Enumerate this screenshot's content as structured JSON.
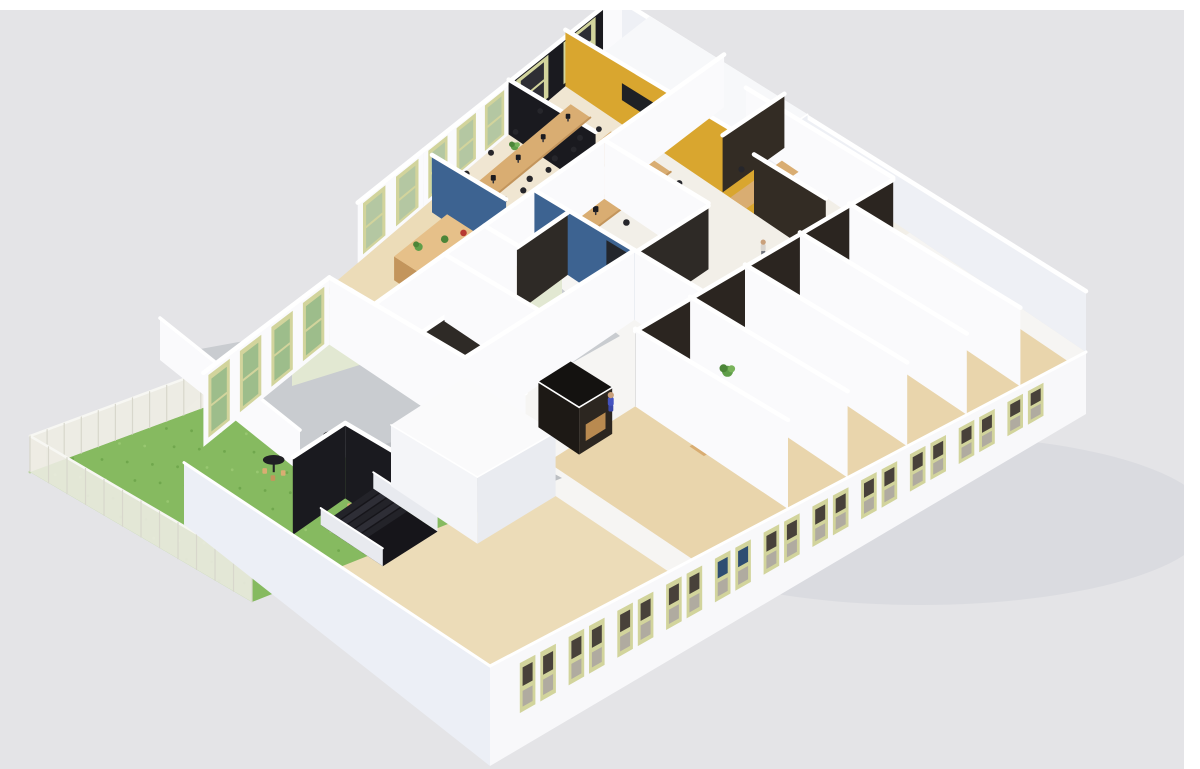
{
  "scene": {
    "description": "Isometric 3D cutaway rendering of a single-storey office floor plan with open office, meeting rooms, cafe, terrace and lawn",
    "canvas": {
      "width": 1200,
      "height": 769,
      "background": "#e4e4e7"
    },
    "frame": {
      "top_strip_height": 10,
      "right_strip_width": 16,
      "strip_color": "#ffffff"
    },
    "palette": {
      "bg": "#e4e4e7",
      "wallFace": "#fafafc",
      "wallShade": "#eef0f5",
      "wallCool": "#eceff6",
      "facade": "#f8f8fa",
      "black": "#1a1a1f",
      "glass": "#2e2a26",
      "glassDark": "#2b2520",
      "glassBrown": "#332c24",
      "accentBlue": "#3d6391",
      "accentYellow": "#d9a62f",
      "frame": "#d2d49c",
      "paneTree": "#b4c7a2",
      "paneGrass": "#9dbd8b",
      "paneNight": "#2e2e34",
      "paneDark": "#48413a",
      "paneGrey": "#b0aba0",
      "paneBlue": "#2e4d72",
      "floorWhite": "#f6f5f3",
      "floorWood1": "#ecdcb8",
      "floorWood2": "#f0e6d2",
      "floorWood3": "#e9d5ac",
      "floorCool": "#f2efe8",
      "wood": "#d9ad72",
      "woodDark": "#c3955c",
      "deskTop": "#e6c089",
      "chair": "#26262b",
      "monitor": "#1b1b20",
      "grass": "#86ba60",
      "grassDark": "#6aa348",
      "path": "#bcbfc3",
      "terrace": "#c9ccd0",
      "greenWall": "#e2e8d2",
      "green": "#5f9e49",
      "greenDark": "#4c8538",
      "skin": "#c9a07b",
      "yellowChair": "#dba63e",
      "rail": "#e8eaef"
    },
    "projection": {
      "quad": [
        [
          150,
          440
        ],
        [
          622,
          38
        ],
        [
          1086,
          352
        ],
        [
          490,
          666
        ]
      ],
      "wall_height": {
        "base": 46,
        "u_gain": 26,
        "v_gain": 30
      }
    },
    "shadow": {
      "cx": 920,
      "cy": 520,
      "rx": 290,
      "ry": 85,
      "color": "#cfd0d6",
      "opacity": 0.45
    },
    "floors": [
      {
        "id": "floor-slab",
        "poly": [
          [
            0,
            0
          ],
          [
            1,
            0
          ],
          [
            1,
            1
          ],
          [
            0,
            1
          ]
        ],
        "fill": "floorWhite",
        "z": 0
      },
      {
        "id": "floor-reception",
        "poly": [
          [
            0.3,
            0
          ],
          [
            0.58,
            0
          ],
          [
            0.58,
            0.22
          ],
          [
            0.3,
            0.22
          ]
        ],
        "fill": "floorWood1",
        "z": 0.1
      },
      {
        "id": "floor-open-office",
        "poly": [
          [
            0.58,
            0
          ],
          [
            0.88,
            0
          ],
          [
            0.88,
            0.3
          ],
          [
            0.58,
            0.3
          ]
        ],
        "fill": "floorWood2",
        "z": 0.1
      },
      {
        "id": "floor-cafe",
        "poly": [
          [
            0,
            0.1
          ],
          [
            0.3,
            0.1
          ],
          [
            0.3,
            1
          ],
          [
            0,
            1
          ]
        ],
        "fill": "floorWood1",
        "z": 0.1
      },
      {
        "id": "floor-right-cluster",
        "poly": [
          [
            0.62,
            0.22
          ],
          [
            1,
            0.22
          ],
          [
            1,
            0.62
          ],
          [
            0.62,
            0.62
          ]
        ],
        "fill": "floorCool",
        "z": 0.1
      },
      {
        "id": "floor-front-offices",
        "poly": [
          [
            0.34,
            0.62
          ],
          [
            0.97,
            0.62
          ],
          [
            0.97,
            1
          ],
          [
            0.34,
            1
          ]
        ],
        "fill": "floorWood3",
        "z": 0.1
      }
    ],
    "floor_patch": {
      "id": "floor-patch-reception",
      "poly": [
        [
          0.4,
          0
        ],
        [
          0.62,
          0
        ],
        [
          0.62,
          0.3
        ],
        [
          0.4,
          0.3
        ]
      ],
      "fill": "floorWood1",
      "z": 9
    },
    "outdoor": {
      "lawn": {
        "points": [
          [
            30,
            472
          ],
          [
            235,
            396
          ],
          [
            458,
            520
          ],
          [
            252,
            602
          ]
        ],
        "fill": "grass",
        "z": 1
      },
      "path": {
        "points": [
          [
            235,
            396
          ],
          [
            340,
            357
          ],
          [
            562,
            478
          ],
          [
            458,
            520
          ]
        ],
        "fill": "path",
        "z": 2
      },
      "terrace_floor": {
        "points": [
          [
            162,
            356
          ],
          [
            556,
            284
          ],
          [
            620,
            336
          ],
          [
            470,
            420
          ],
          [
            300,
            468
          ]
        ],
        "fill": "terrace",
        "z": 3
      },
      "fences": [
        {
          "id": "fence-northwest",
          "points": [
            [
              30,
              472
            ],
            [
              235,
              396
            ],
            [
              235,
              360
            ],
            [
              30,
              436
            ]
          ],
          "posts": 12,
          "z": 4
        },
        {
          "id": "fence-southwest",
          "points": [
            [
              30,
              472
            ],
            [
              252,
              602
            ],
            [
              252,
              566
            ],
            [
              30,
              436
            ]
          ],
          "posts": 12,
          "z": 5
        }
      ],
      "terrace_walls": [
        {
          "id": "terrace-wall-green",
          "face": [
            [
              292,
              308
            ],
            [
              562,
              224
            ],
            [
              562,
              302
            ],
            [
              292,
              386
            ]
          ],
          "fill": "greenWall",
          "z": 6,
          "openings": [
            {
              "t": [
                0.4,
                0.52
              ],
              "fy": [
                0.28,
                0.88
              ],
              "fill": "#eef1e2"
            },
            {
              "t": [
                0.62,
                0.72
              ],
              "fy": [
                0.1,
                0.94
              ],
              "fill": "#edf0e0"
            },
            {
              "t": [
                0.78,
                0.88
              ],
              "fy": [
                0.1,
                0.94
              ],
              "fill": "#edf0e0"
            }
          ]
        },
        {
          "id": "terrace-wall-low",
          "face": [
            [
              160,
              318
            ],
            [
              300,
              430
            ],
            [
              300,
              472
            ],
            [
              160,
              360
            ]
          ],
          "fill": "wallFace",
          "z": 7,
          "openings": []
        }
      ],
      "terrace_table": {
        "cx": 395,
        "cy": 296,
        "z": 8
      }
    },
    "walls": [
      {
        "id": "wall-nw-reception",
        "u1": 0.44,
        "v1": 0,
        "u2": 0.58,
        "v2": 0,
        "fill": "wallFace",
        "z": 10,
        "windows": {
          "count": 2,
          "pane": "paneTree"
        }
      },
      {
        "id": "wall-nw-open-office",
        "u1": 0.58,
        "v1": 0,
        "u2": 0.76,
        "v2": 0,
        "fill": "wallFace",
        "z": 10.1,
        "windows": {
          "count": 3,
          "pane": "paneTree"
        }
      },
      {
        "id": "wall-nw-black",
        "u1": 0.76,
        "v1": 0,
        "u2": 0.96,
        "v2": 0,
        "fill": "black",
        "z": 10.2,
        "windows": {
          "count": 2,
          "pane": "paneNight"
        }
      },
      {
        "id": "wall-nw-end",
        "u1": 0.96,
        "v1": 0,
        "u2": 1,
        "v2": 0,
        "fill": "wallFace",
        "z": 10.3
      },
      {
        "id": "wall-ne-facade",
        "u1": 1,
        "v1": 0,
        "u2": 1,
        "v2": 1,
        "fill": "wallShade",
        "z": 11,
        "hMul": 0.8
      },
      {
        "id": "wall-yellow-accent",
        "u1": 0.88,
        "v1": 0,
        "u2": 0.88,
        "v2": 0.42,
        "fill": "accentYellow",
        "z": 16,
        "hMul": 1.15,
        "tv": {
          "t": [
            0.3,
            0.54
          ],
          "fy": [
            0.32,
            0.6
          ],
          "fill": "#1f2125"
        }
      },
      {
        "id": "wall-black-tall",
        "u1": 0.76,
        "v1": 0,
        "u2": 0.76,
        "v2": 0.2,
        "fill": "black",
        "z": 17,
        "hMul": 1.05
      },
      {
        "id": "wall-blue-reception",
        "u1": 0.58,
        "v1": 0.02,
        "u2": 0.58,
        "v2": 0.2,
        "fill": "accentBlue",
        "z": 20
      },
      {
        "id": "wall-reception-front",
        "u1": 0.44,
        "v1": 0.22,
        "u2": 0.58,
        "v2": 0.22,
        "fill": "wallFace",
        "z": 21,
        "hMul": 0.9
      },
      {
        "id": "wall-cafe-windows",
        "u1": 0.04,
        "v1": 0.1,
        "u2": 0.3,
        "v2": 0.1,
        "fill": "wallFace",
        "z": 21.5,
        "windows": {
          "count": 4,
          "pane": "paneGrass"
        }
      },
      {
        "id": "wall-center-back",
        "u1": 0.3,
        "v1": 0.22,
        "u2": 0.76,
        "v2": 0.22,
        "fill": "wallFace",
        "z": 24
      },
      {
        "id": "wall-right-back",
        "u1": 0.76,
        "v1": 0.22,
        "u2": 1,
        "v2": 0.22,
        "fill": "wallFace",
        "z": 24.2
      },
      {
        "id": "wall-right-divider-far",
        "u1": 0.97,
        "v1": 0.3,
        "u2": 0.97,
        "v2": 0.62,
        "fill": "wallFace",
        "z": 31.5
      },
      {
        "id": "wall-right-glass-1",
        "u1": 0.88,
        "v1": 0.35,
        "u2": 1,
        "v2": 0.35,
        "fill": "glassBrown",
        "z": 32.5,
        "hMul": 0.96
      },
      {
        "id": "wall-right-glass-2",
        "u1": 0.88,
        "v1": 0.42,
        "u2": 0.88,
        "v2": 0.58,
        "fill": "glassBrown",
        "z": 34,
        "hMul": 0.96
      },
      {
        "id": "wall-right-divider-1",
        "u1": 0.76,
        "v1": 0.22,
        "u2": 0.76,
        "v2": 0.46,
        "fill": "wallFace",
        "z": 35.5
      },
      {
        "id": "wall-right-glass-3",
        "u1": 0.62,
        "v1": 0.46,
        "u2": 0.76,
        "v2": 0.46,
        "fill": "glass",
        "z": 37,
        "hMul": 0.96
      },
      {
        "id": "wall-right-divider-2",
        "u1": 0.62,
        "v1": 0.46,
        "u2": 0.62,
        "v2": 0.62,
        "fill": "wallFace",
        "z": 38
      },
      {
        "id": "wall-blue-center",
        "u1": 0.62,
        "v1": 0.22,
        "u2": 0.62,
        "v2": 0.46,
        "fill": "accentBlue",
        "z": 38.6,
        "door": {
          "t": [
            0.72,
            0.94
          ],
          "fy": [
            0.1,
            0.97
          ],
          "fill": "#23262c"
        }
      },
      {
        "id": "wall-center-glass-2",
        "u1": 0.52,
        "v1": 0.3,
        "u2": 0.62,
        "v2": 0.3,
        "fill": "glass",
        "z": 38.65,
        "hMul": 0.96
      },
      {
        "id": "wall-center-divider-2",
        "u1": 0.52,
        "v1": 0.22,
        "u2": 0.52,
        "v2": 0.3,
        "fill": "wallFace",
        "z": 38.7
      },
      {
        "id": "wall-center-glass-1",
        "u1": 0.3,
        "v1": 0.34,
        "u2": 0.44,
        "v2": 0.34,
        "fill": "glass",
        "z": 38.9,
        "hMul": 0.96
      },
      {
        "id": "wall-center-divider-1",
        "u1": 0.44,
        "v1": 0.22,
        "u2": 0.44,
        "v2": 0.46,
        "fill": "wallFace",
        "z": 38.95
      },
      {
        "id": "wall-cafe-divider",
        "u1": 0.3,
        "v1": 0.1,
        "u2": 0.3,
        "v2": 0.62,
        "fill": "wallFace",
        "z": 39.2
      },
      {
        "id": "wall-corridor-north",
        "u1": 0.3,
        "v1": 0.46,
        "u2": 0.62,
        "v2": 0.46,
        "fill": "wallFace",
        "z": 39.3
      },
      {
        "id": "wall-cafe-dark-1",
        "u1": 0,
        "v1": 0.42,
        "u2": 0.1,
        "v2": 0.42,
        "fill": "black",
        "z": 46,
        "hMul": 0.92
      },
      {
        "id": "wall-cafe-dark-2",
        "u1": 0.1,
        "v1": 0.42,
        "u2": 0.1,
        "v2": 0.56,
        "fill": "black",
        "z": 47,
        "hMul": 0.92
      },
      {
        "id": "wall-front-glass-row",
        "u1": 0.5,
        "v1": 0.62,
        "u2": 0.97,
        "v2": 0.62,
        "fill": "glassDark",
        "z": 52,
        "hMul": 0.97
      },
      {
        "id": "wall-front-divider-5",
        "u1": 0.89,
        "v1": 0.62,
        "u2": 0.89,
        "v2": 1,
        "fill": "wallFace",
        "z": 53.0
      },
      {
        "id": "wall-front-divider-4",
        "u1": 0.8,
        "v1": 0.62,
        "u2": 0.8,
        "v2": 1,
        "fill": "wallFace",
        "z": 53.2
      },
      {
        "id": "wall-front-divider-3",
        "u1": 0.7,
        "v1": 0.62,
        "u2": 0.7,
        "v2": 1,
        "fill": "wallFace",
        "z": 53.4
      },
      {
        "id": "wall-front-divider-2",
        "u1": 0.6,
        "v1": 0.62,
        "u2": 0.6,
        "v2": 1,
        "fill": "wallFace",
        "z": 53.5
      },
      {
        "id": "wall-front-divider-1",
        "u1": 0.5,
        "v1": 0.62,
        "u2": 0.5,
        "v2": 1,
        "fill": "wallFace",
        "z": 53.7
      },
      {
        "id": "wall-se-facade",
        "u1": 0,
        "v1": 1,
        "u2": 1,
        "v2": 1,
        "fill": "facade",
        "z": 60,
        "plinth": [
          100,
          62
        ],
        "pairs": {
          "count": 11,
          "t0": 0.05,
          "t1": 0.95,
          "blue_slot": 4
        }
      },
      {
        "id": "wall-sw-facade",
        "u1": 0,
        "v1": 0.1,
        "u2": 0,
        "v2": 1,
        "fill": "wallCool",
        "z": 61,
        "plinth": [
          62,
          100
        ]
      }
    ],
    "boxes": [
      {
        "id": "meeting-room-block",
        "u1": 0.88,
        "v1": 0.06,
        "u2": 1,
        "v2": 0.4,
        "hMul": 0.85,
        "roof": "#f7f8fa",
        "faceSW": "#f2f3f7",
        "faceSE": "#edeff4",
        "z": 15
      },
      {
        "id": "wc-block",
        "u1": 0.16,
        "v1": 0.46,
        "u2": 0.3,
        "v2": 0.7,
        "hMul": 0.75,
        "roof": "#fafafb",
        "faceSW": "#f4f5f8",
        "faceSE": "#e9ebf0",
        "z": 49
      },
      {
        "id": "phone-booth",
        "u1": 0.38,
        "v1": 0.54,
        "u2": 0.44,
        "v2": 0.645,
        "hMul": 0.58,
        "roof": "#141210",
        "faceSW": "#1d1915",
        "faceSE": "#2c2620",
        "seat": "#b98a50",
        "z": 50
      }
    ],
    "furniture": {
      "desk_rows": [
        {
          "u0": 0.6,
          "u1": 0.86,
          "v": 0.055,
          "desks": 5,
          "z": 18
        },
        {
          "u0": 0.6,
          "u1": 0.86,
          "v": 0.145,
          "desks": 5,
          "z": 18.1
        },
        {
          "u0": 0.6,
          "u1": 0.86,
          "v": 0.235,
          "desks": 5,
          "z": 18.2
        }
      ],
      "reception_desk": {
        "u0": 0.45,
        "u1": 0.56,
        "v0": 0.08,
        "v1": 0.15,
        "z": 22
      },
      "office_desks": [
        {
          "id": "right-office-desk",
          "u": 0.93,
          "v": 0.385,
          "z": 33.5
        },
        {
          "id": "front-office-desk-3",
          "u": 0.845,
          "v": 0.76,
          "z": 53.1
        },
        {
          "id": "front-office-desk-2",
          "u": 0.72,
          "v": 0.78,
          "z": 53.3
        },
        {
          "id": "front-office-desk-1",
          "u": 0.545,
          "v": 0.78,
          "z": 53.6
        }
      ],
      "bistro_tables": [
        {
          "u": 0.07,
          "v": 0.26,
          "z": 45
        },
        {
          "u": 0.16,
          "v": 0.3,
          "z": 45.1
        },
        {
          "u": 0.1,
          "v": 0.46,
          "z": 45.2
        }
      ],
      "plants": [
        {
          "u": 0.605,
          "v": 0.025,
          "z": 19
        },
        {
          "u": 0.745,
          "v": 0.03,
          "z": 19.1
        },
        {
          "u": 0.955,
          "v": 0.4,
          "z": 33.2
        },
        {
          "u": 0.77,
          "v": 0.295,
          "z": 35.2
        },
        {
          "u": 0.87,
          "v": 0.665,
          "z": 53.15
        },
        {
          "u": 0.75,
          "v": 0.665,
          "z": 53.35
        },
        {
          "u": 0.63,
          "v": 0.67,
          "z": 53.55
        }
      ],
      "stairs": {
        "u0": 0.04,
        "u1": 0.14,
        "v0": 0.44,
        "v1": 0.62,
        "z": 48
      },
      "people": [
        {
          "id": "person-receptionist",
          "u": 0.435,
          "v": 0.175,
          "pose": "standing",
          "shirt": "#343a52",
          "pants": "#2b3046",
          "z": 23
        },
        {
          "id": "person-right-office",
          "u": 0.935,
          "v": 0.43,
          "pose": "sitting",
          "shirt": "#96694a",
          "z": 33.6
        },
        {
          "id": "person-standing-right",
          "u": 0.83,
          "v": 0.5,
          "pose": "standing",
          "shirt": "#d8d4cf",
          "pants": "#6b6f78",
          "z": 35.3
        },
        {
          "id": "person-blue-overalls",
          "u": 0.47,
          "v": 0.6,
          "pose": "standing",
          "shirt": "#4553c0",
          "pants": "#3a47a8",
          "z": 51
        },
        {
          "id": "person-front-office",
          "u": 0.72,
          "v": 0.79,
          "pose": "sitting",
          "shirt": "#40434e",
          "z": 53.32
        }
      ]
    },
    "regions": [
      "lawn",
      "terrace",
      "cafe",
      "stairwell",
      "wc-block",
      "phone-booth",
      "reception",
      "open-office",
      "meeting-room-block",
      "center-meeting-rooms",
      "right-offices",
      "front-offices",
      "corridor"
    ]
  }
}
